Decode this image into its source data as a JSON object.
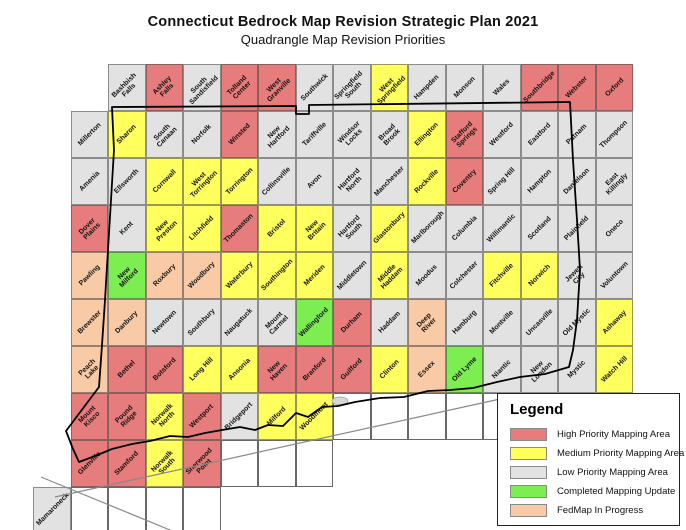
{
  "title": {
    "line1": "Connecticut Bedrock Map Revision Strategic Plan 2021",
    "line2": "Quadrangle Map Revision Priorities"
  },
  "colors": {
    "high": "#e77c7c",
    "medium": "#ffff5e",
    "low": "#e2e2e2",
    "completed": "#7dee52",
    "fedmap": "#f8cba6",
    "ocean": "#ffffff",
    "state_border": "#000000",
    "shoreline_line": "#8a8a8a"
  },
  "legend": {
    "title": "Legend",
    "items": [
      {
        "key": "high",
        "label": "High Priority Mapping Area"
      },
      {
        "key": "medium",
        "label": "Medium Priority Mapping Area"
      },
      {
        "key": "low",
        "label": "Low Priority Mapping Area"
      },
      {
        "key": "completed",
        "label": "Completed Mapping Update"
      },
      {
        "key": "fedmap",
        "label": "FedMap In Progress"
      }
    ]
  },
  "map": {
    "rows": [
      {
        "row": 0,
        "start_col": 2,
        "quads": [
          {
            "name": "Bashbish Falls",
            "priority": "low"
          },
          {
            "name": "Ashley Falls",
            "priority": "high"
          },
          {
            "name": "South Sandisfield",
            "priority": "low"
          },
          {
            "name": "Tolland Center",
            "priority": "high"
          },
          {
            "name": "West Granville",
            "priority": "high"
          },
          {
            "name": "Southwick",
            "priority": "low"
          },
          {
            "name": "Springfield South",
            "priority": "low"
          },
          {
            "name": "West Springfield",
            "priority": "medium"
          },
          {
            "name": "Hampden",
            "priority": "low"
          },
          {
            "name": "Monson",
            "priority": "low"
          },
          {
            "name": "Wales",
            "priority": "low"
          },
          {
            "name": "Southbridge",
            "priority": "high"
          },
          {
            "name": "Webster",
            "priority": "high"
          },
          {
            "name": "Oxford",
            "priority": "high"
          }
        ]
      },
      {
        "row": 1,
        "start_col": 1,
        "quads": [
          {
            "name": "Millerton",
            "priority": "low"
          },
          {
            "name": "Sharon",
            "priority": "medium"
          },
          {
            "name": "South Canaan",
            "priority": "low"
          },
          {
            "name": "Norfolk",
            "priority": "low"
          },
          {
            "name": "Winsted",
            "priority": "high"
          },
          {
            "name": "New Hartford",
            "priority": "low"
          },
          {
            "name": "Tariffville",
            "priority": "low"
          },
          {
            "name": "Windsor Locks",
            "priority": "low"
          },
          {
            "name": "Broad Brook",
            "priority": "low"
          },
          {
            "name": "Ellington",
            "priority": "medium"
          },
          {
            "name": "Stafford Springs",
            "priority": "high"
          },
          {
            "name": "Westford",
            "priority": "low"
          },
          {
            "name": "Eastford",
            "priority": "low"
          },
          {
            "name": "Putnam",
            "priority": "low"
          },
          {
            "name": "Thompson",
            "priority": "low"
          }
        ]
      },
      {
        "row": 2,
        "start_col": 1,
        "quads": [
          {
            "name": "Amenia",
            "priority": "low"
          },
          {
            "name": "Ellsworth",
            "priority": "low"
          },
          {
            "name": "Cornwall",
            "priority": "medium"
          },
          {
            "name": "West Torrington",
            "priority": "medium"
          },
          {
            "name": "Torrington",
            "priority": "medium"
          },
          {
            "name": "Collinsville",
            "priority": "low"
          },
          {
            "name": "Avon",
            "priority": "low"
          },
          {
            "name": "Hartford North",
            "priority": "low"
          },
          {
            "name": "Manchester",
            "priority": "low"
          },
          {
            "name": "Rockville",
            "priority": "medium"
          },
          {
            "name": "Coventry",
            "priority": "high"
          },
          {
            "name": "Spring Hill",
            "priority": "low"
          },
          {
            "name": "Hampton",
            "priority": "low"
          },
          {
            "name": "Danielson",
            "priority": "low"
          },
          {
            "name": "East Killingly",
            "priority": "low"
          }
        ]
      },
      {
        "row": 3,
        "start_col": 1,
        "quads": [
          {
            "name": "Dover Plains",
            "priority": "high"
          },
          {
            "name": "Kent",
            "priority": "low"
          },
          {
            "name": "New Preston",
            "priority": "medium"
          },
          {
            "name": "Litchfield",
            "priority": "medium"
          },
          {
            "name": "Thomaston",
            "priority": "high"
          },
          {
            "name": "Bristol",
            "priority": "medium"
          },
          {
            "name": "New Britain",
            "priority": "medium"
          },
          {
            "name": "Hartford South",
            "priority": "low"
          },
          {
            "name": "Glastonbury",
            "priority": "medium"
          },
          {
            "name": "Marlborough",
            "priority": "low"
          },
          {
            "name": "Columbia",
            "priority": "low"
          },
          {
            "name": "Willimantic",
            "priority": "low"
          },
          {
            "name": "Scotland",
            "priority": "low"
          },
          {
            "name": "Plainfield",
            "priority": "low"
          },
          {
            "name": "Oneco",
            "priority": "low"
          }
        ]
      },
      {
        "row": 4,
        "start_col": 1,
        "quads": [
          {
            "name": "Pawling",
            "priority": "fedmap"
          },
          {
            "name": "New Milford",
            "priority": "completed"
          },
          {
            "name": "Roxbury",
            "priority": "fedmap"
          },
          {
            "name": "Woodbury",
            "priority": "fedmap"
          },
          {
            "name": "Waterbury",
            "priority": "medium"
          },
          {
            "name": "Southington",
            "priority": "medium"
          },
          {
            "name": "Meriden",
            "priority": "medium"
          },
          {
            "name": "Middletown",
            "priority": "low"
          },
          {
            "name": "Middle Haddam",
            "priority": "medium"
          },
          {
            "name": "Moodus",
            "priority": "low"
          },
          {
            "name": "Colchester",
            "priority": "low"
          },
          {
            "name": "Fitchville",
            "priority": "medium"
          },
          {
            "name": "Norwich",
            "priority": "medium"
          },
          {
            "name": "Jewett City",
            "priority": "low"
          },
          {
            "name": "Voluntown",
            "priority": "low"
          }
        ]
      },
      {
        "row": 5,
        "start_col": 1,
        "quads": [
          {
            "name": "Brewster",
            "priority": "fedmap"
          },
          {
            "name": "Danbury",
            "priority": "fedmap"
          },
          {
            "name": "Newtown",
            "priority": "low"
          },
          {
            "name": "Southbury",
            "priority": "low"
          },
          {
            "name": "Naugatuck",
            "priority": "low"
          },
          {
            "name": "Mount Carmel",
            "priority": "low"
          },
          {
            "name": "Wallingford",
            "priority": "completed"
          },
          {
            "name": "Durham",
            "priority": "high"
          },
          {
            "name": "Haddam",
            "priority": "low"
          },
          {
            "name": "Deep River",
            "priority": "fedmap"
          },
          {
            "name": "Hamburg",
            "priority": "low"
          },
          {
            "name": "Montville",
            "priority": "low"
          },
          {
            "name": "Uncasville",
            "priority": "low"
          },
          {
            "name": "Old Mystic",
            "priority": "low"
          },
          {
            "name": "Ashaway",
            "priority": "medium"
          }
        ]
      },
      {
        "row": 6,
        "start_col": 1,
        "quads": [
          {
            "name": "Peach Lake",
            "priority": "fedmap"
          },
          {
            "name": "Bethel",
            "priority": "high"
          },
          {
            "name": "Botsford",
            "priority": "high"
          },
          {
            "name": "Long Hill",
            "priority": "medium"
          },
          {
            "name": "Ansonia",
            "priority": "medium"
          },
          {
            "name": "New Haven",
            "priority": "high"
          },
          {
            "name": "Branford",
            "priority": "high"
          },
          {
            "name": "Guilford",
            "priority": "high"
          },
          {
            "name": "Clinton",
            "priority": "medium"
          },
          {
            "name": "Essex",
            "priority": "fedmap"
          },
          {
            "name": "Old Lyme",
            "priority": "completed"
          },
          {
            "name": "Niantic",
            "priority": "low"
          },
          {
            "name": "New London",
            "priority": "low"
          },
          {
            "name": "Mystic",
            "priority": "low"
          },
          {
            "name": "Watch Hill",
            "priority": "medium"
          }
        ]
      },
      {
        "row": 7,
        "start_col": 1,
        "quads": [
          {
            "name": "Mount Kisco",
            "priority": "high"
          },
          {
            "name": "Pound Ridge",
            "priority": "high"
          },
          {
            "name": "Norwalk North",
            "priority": "medium"
          },
          {
            "name": "Westport",
            "priority": "high"
          },
          {
            "name": "Bridgeport",
            "priority": "low"
          },
          {
            "name": "Milford",
            "priority": "medium"
          },
          {
            "name": "Woodmont",
            "priority": "medium"
          }
        ]
      },
      {
        "row": 8,
        "start_col": 1,
        "quads": [
          {
            "name": "Glenville",
            "priority": "high"
          },
          {
            "name": "Stamford",
            "priority": "high"
          },
          {
            "name": "Norwalk South",
            "priority": "medium"
          },
          {
            "name": "Sherwood Point",
            "priority": "high"
          }
        ]
      },
      {
        "row": 9,
        "start_col": 0,
        "quads": [
          {
            "name": "Mamaroneck",
            "priority": "low"
          }
        ]
      }
    ],
    "ocean_cells": [
      {
        "row": 7,
        "start_col": 8,
        "count": 5
      },
      {
        "row": 8,
        "start_col": 5,
        "count": 3
      },
      {
        "row": 9,
        "start_col": 1,
        "count": 4
      }
    ]
  }
}
